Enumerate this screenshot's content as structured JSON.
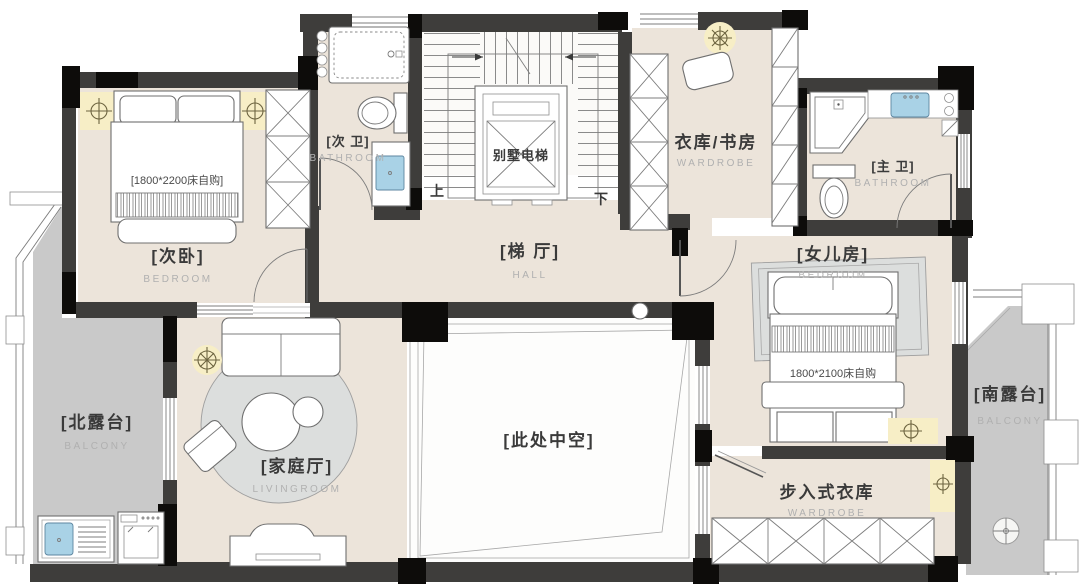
{
  "title": "villa-second-floor-plan",
  "colors": {
    "wall": "#3e3d3b",
    "column": "#0d0c0a",
    "floor": "#ece4da",
    "balcony_floor": "#c9c9c9",
    "water_blue": "#a9d2e6",
    "light_glow": "#f7eec6"
  },
  "rooms": {
    "bedroom2": {
      "name": "[次卧]",
      "type": "BEDROOM",
      "note": "[1800*2200床自购]"
    },
    "bath2": {
      "name": "[次 卫]",
      "type": "BATHROOM"
    },
    "elevator": {
      "name": "别墅电梯"
    },
    "stairs": {
      "up": "上",
      "down": "下"
    },
    "hall": {
      "name": "[梯 厅]",
      "type": "HALL"
    },
    "study": {
      "name": "衣库/书房",
      "type": "WARDROBE"
    },
    "master_bath": {
      "name": "[主 卫]",
      "type": "BATHROOM"
    },
    "daughter": {
      "name": "[女儿房]",
      "type": "BEDROOM",
      "note": "1800*2100床自购"
    },
    "void": {
      "name": "[此处中空]"
    },
    "living": {
      "name": "[家庭厅]",
      "type": "LIVINGROOM"
    },
    "north_balcony": {
      "name": "[北露台]",
      "type": "BALCONY"
    },
    "south_balcony": {
      "name": "[南露台]",
      "type": "BALCONY"
    },
    "closet": {
      "name": "步入式衣库",
      "type": "WARDROBE"
    }
  }
}
